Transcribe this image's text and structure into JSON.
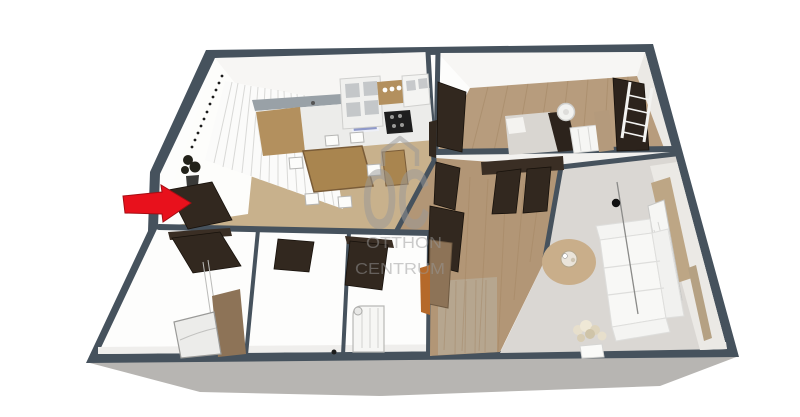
{
  "watermark": {
    "logo": "OC",
    "line1": "OTTHON",
    "line2": "CENTRUM"
  },
  "colors": {
    "wall": "#46525d",
    "slab": "#b7b5b2",
    "base": "#fdfdfc",
    "face_light": "#f7f6f4",
    "face_shade": "#ebe9e5",
    "floor_kitchen": "#c8b18c",
    "floor_wood": "#b79c7d",
    "floor_hall": "#b29676",
    "floor_panel": "#b6a68f",
    "floor_gray": "#dad7d3",
    "grain": "#a0835f",
    "door": "#32281f",
    "door_edge": "#17110b",
    "tan": "#a9854f",
    "tan_light": "#b3905e",
    "counter": "#ececea",
    "backsplash": "#99a1a7",
    "sink": "#8f99c9",
    "stove": "#1e1e1e",
    "curtain": "#fbfbfa",
    "curtain_line": "#d9d9d7",
    "rug": "#c9ae8a",
    "sofa": "#f8f8f6",
    "sofa_line": "#dededc",
    "window_tan": "#bda685",
    "white_obj": "#f6f6f4",
    "mattress": "#d9d6d1",
    "dark_furn": "#2c231c",
    "wood_panel": "#8d7357",
    "arrow": "#e8111c",
    "arrow_edge": "#a50d13",
    "watermark": "#999999"
  },
  "scene": {
    "type": "3d-floor-plan",
    "rooms": [
      "kitchen-dining",
      "bedroom",
      "hallway",
      "living-room",
      "bathroom",
      "wc",
      "storage"
    ],
    "marker": "entrance-arrow"
  }
}
